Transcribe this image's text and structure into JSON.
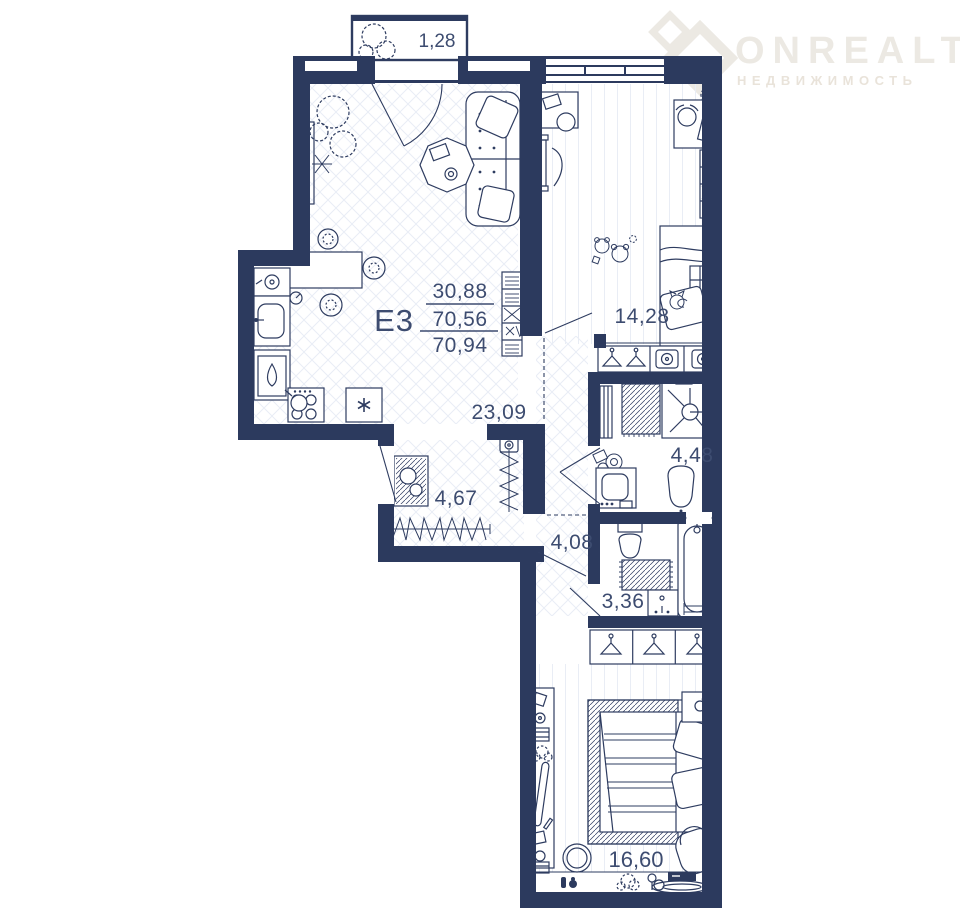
{
  "watermark": {
    "brand": "ONREALT",
    "subtitle": "НЕДВИЖИМОСТЬ"
  },
  "unit": {
    "code": "E3",
    "area_living": "30,88",
    "area_heated": "70,56",
    "area_total": "70,94"
  },
  "rooms": {
    "balcony_top": {
      "name": "balcony",
      "area": "1,28"
    },
    "kids_room": {
      "name": "kids-bedroom",
      "area": "14,28"
    },
    "hall": {
      "name": "living-hall",
      "area": "23,09"
    },
    "closet": {
      "name": "wardrobe-room",
      "area": "4,67"
    },
    "shower_room": {
      "name": "shower-room",
      "area": "4,48"
    },
    "corridor": {
      "name": "corridor",
      "area": "4,08"
    },
    "bathroom": {
      "name": "bathroom",
      "area": "3,36"
    },
    "bedroom": {
      "name": "master-bedroom",
      "area": "16,60"
    }
  },
  "colors": {
    "wall": "#2c3a5e",
    "line": "#2e3c60",
    "label": "#3d4c70",
    "floor_hatch": "#e9edf5",
    "watermark": "#ece9e3",
    "watermark_sub": "#e9e3da"
  }
}
